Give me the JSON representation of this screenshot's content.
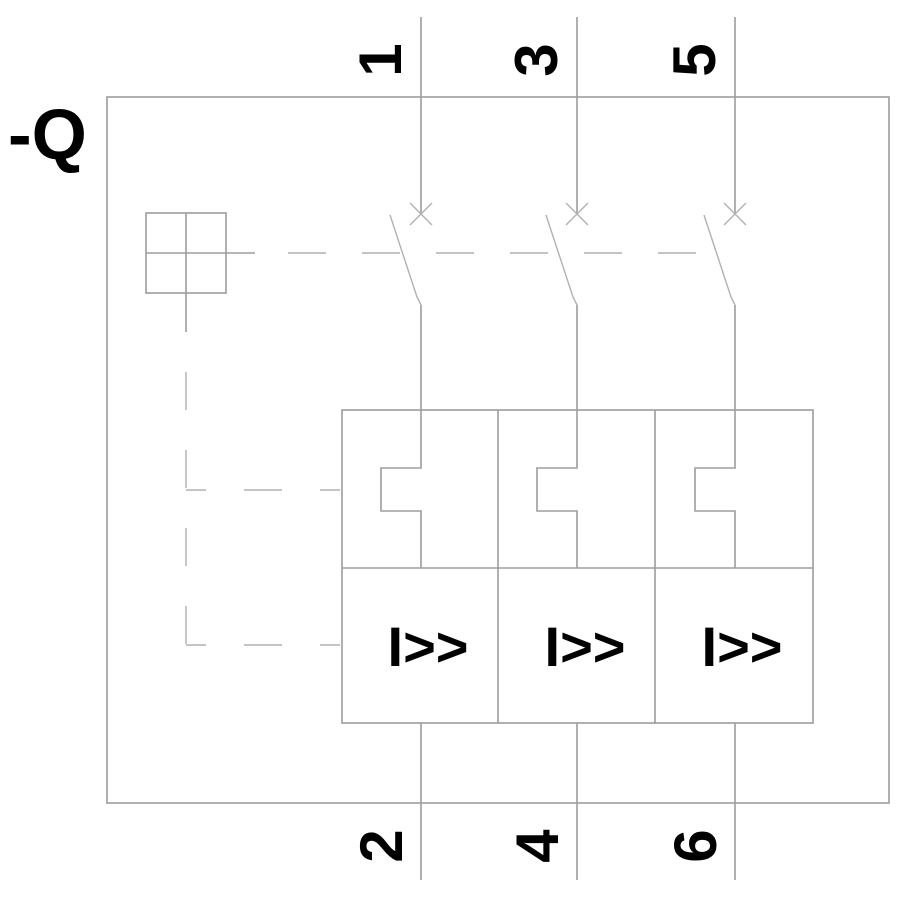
{
  "device": {
    "designation": "-Q"
  },
  "terminals": {
    "top": [
      "1",
      "3",
      "5"
    ],
    "bottom": [
      "2",
      "4",
      "6"
    ]
  },
  "releases": {
    "labels": [
      "I>>",
      "I>>",
      "I>>"
    ]
  },
  "colors": {
    "line": "#9d9d9d",
    "line_light": "#b1b1b1",
    "text": "#000000",
    "background": "#ffffff"
  }
}
